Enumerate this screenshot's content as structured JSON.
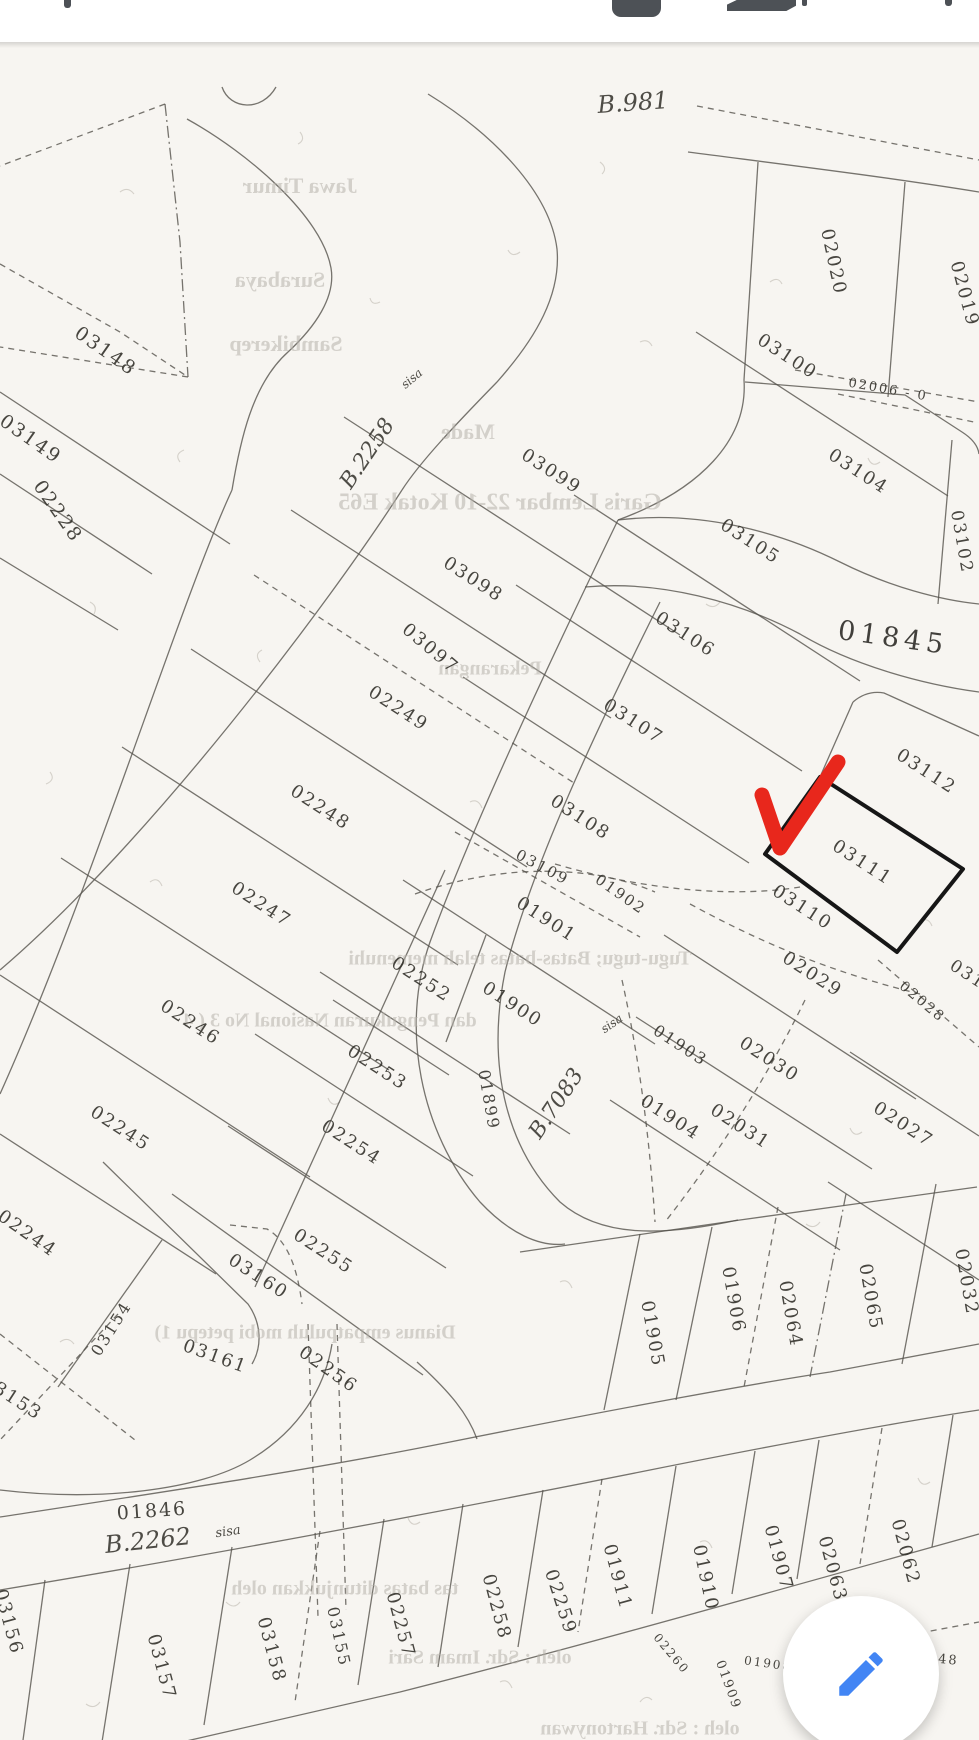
{
  "app": {
    "colors": {
      "accent_red": "#e8271c",
      "fab_blue": "#4285f4",
      "paper": "#f7f5f1",
      "icon_gray": "#4d5156"
    }
  },
  "toolbar": {
    "icons": [
      {
        "name": "share-icon"
      },
      {
        "name": "save-icon"
      },
      {
        "name": "print-icon"
      },
      {
        "name": "more-icon"
      }
    ]
  },
  "map": {
    "type": "cadastral-parcel-map",
    "selected_parcel": "03111",
    "marker": {
      "shape": "red-check-arrow",
      "color": "#e8271c",
      "points_at": "03111"
    },
    "parcel_labels": [
      {
        "t": "03148",
        "x": 105,
        "y": 310,
        "r": 35,
        "s": 19
      },
      {
        "t": "03149",
        "x": 30,
        "y": 398,
        "r": 35,
        "s": 19
      },
      {
        "t": "02228",
        "x": 57,
        "y": 470,
        "r": 55,
        "s": 19
      },
      {
        "t": "03100",
        "x": 787,
        "y": 315,
        "r": 33,
        "s": 18
      },
      {
        "t": "02020",
        "x": 833,
        "y": 220,
        "r": 78,
        "s": 18
      },
      {
        "t": "02019",
        "x": 964,
        "y": 252,
        "r": 75,
        "s": 18
      },
      {
        "t": "02006 - 0",
        "x": 888,
        "y": 348,
        "r": 10,
        "s": 13
      },
      {
        "t": "03099",
        "x": 551,
        "y": 430,
        "r": 33,
        "s": 18
      },
      {
        "t": "03104",
        "x": 858,
        "y": 430,
        "r": 33,
        "s": 18
      },
      {
        "t": "03105",
        "x": 750,
        "y": 500,
        "r": 33,
        "s": 18
      },
      {
        "t": "03098",
        "x": 473,
        "y": 538,
        "r": 33,
        "s": 18
      },
      {
        "t": "03106",
        "x": 685,
        "y": 593,
        "r": 33,
        "s": 18
      },
      {
        "t": "03097",
        "x": 430,
        "y": 607,
        "r": 40,
        "s": 18
      },
      {
        "t": "01845",
        "x": 893,
        "y": 597,
        "r": 8,
        "s": 27,
        "c": "road"
      },
      {
        "t": "03102",
        "x": 961,
        "y": 500,
        "r": 80,
        "s": 17
      },
      {
        "t": "02249",
        "x": 398,
        "y": 667,
        "r": 33,
        "s": 18
      },
      {
        "t": "03107",
        "x": 633,
        "y": 680,
        "r": 33,
        "s": 18
      },
      {
        "t": "03112",
        "x": 926,
        "y": 730,
        "r": 33,
        "s": 18
      },
      {
        "t": "02248",
        "x": 320,
        "y": 766,
        "r": 33,
        "s": 18
      },
      {
        "t": "03108",
        "x": 580,
        "y": 776,
        "r": 33,
        "s": 18
      },
      {
        "t": "03111",
        "x": 862,
        "y": 821,
        "r": 33,
        "s": 18
      },
      {
        "t": "03109",
        "x": 542,
        "y": 826,
        "r": 28,
        "s": 15
      },
      {
        "t": "01902",
        "x": 620,
        "y": 853,
        "r": 35,
        "s": 15
      },
      {
        "t": "03110",
        "x": 802,
        "y": 866,
        "r": 33,
        "s": 18
      },
      {
        "t": "02247",
        "x": 261,
        "y": 863,
        "r": 33,
        "s": 18
      },
      {
        "t": "01901",
        "x": 546,
        "y": 878,
        "r": 33,
        "s": 18
      },
      {
        "t": "02029",
        "x": 812,
        "y": 933,
        "r": 33,
        "s": 18
      },
      {
        "t": "02252",
        "x": 421,
        "y": 938,
        "r": 33,
        "s": 18
      },
      {
        "t": "01900",
        "x": 512,
        "y": 963,
        "r": 33,
        "s": 18
      },
      {
        "t": "02028",
        "x": 922,
        "y": 960,
        "r": 40,
        "s": 14
      },
      {
        "t": "02246",
        "x": 190,
        "y": 981,
        "r": 33,
        "s": 18
      },
      {
        "t": "01903",
        "x": 680,
        "y": 1004,
        "r": 33,
        "s": 16
      },
      {
        "t": "02030",
        "x": 769,
        "y": 1018,
        "r": 33,
        "s": 18
      },
      {
        "t": "02253",
        "x": 377,
        "y": 1026,
        "r": 33,
        "s": 18
      },
      {
        "t": "01899",
        "x": 488,
        "y": 1058,
        "r": 80,
        "s": 16
      },
      {
        "t": "01904",
        "x": 670,
        "y": 1076,
        "r": 33,
        "s": 18
      },
      {
        "t": "02031",
        "x": 740,
        "y": 1085,
        "r": 33,
        "s": 18
      },
      {
        "t": "02027",
        "x": 903,
        "y": 1083,
        "r": 33,
        "s": 18
      },
      {
        "t": "02245",
        "x": 120,
        "y": 1087,
        "r": 33,
        "s": 18
      },
      {
        "t": "02254",
        "x": 351,
        "y": 1101,
        "r": 33,
        "s": 18
      },
      {
        "t": "02244",
        "x": 27,
        "y": 1192,
        "r": 35,
        "s": 18
      },
      {
        "t": "02255",
        "x": 323,
        "y": 1210,
        "r": 33,
        "s": 18
      },
      {
        "t": "03160",
        "x": 258,
        "y": 1235,
        "r": 33,
        "s": 18
      },
      {
        "t": "02032",
        "x": 966,
        "y": 1240,
        "r": 80,
        "s": 18
      },
      {
        "t": "02065",
        "x": 870,
        "y": 1255,
        "r": 80,
        "s": 18
      },
      {
        "t": "01906",
        "x": 733,
        "y": 1258,
        "r": 80,
        "s": 18
      },
      {
        "t": "02064",
        "x": 790,
        "y": 1272,
        "r": 80,
        "s": 18
      },
      {
        "t": "03154",
        "x": 112,
        "y": 1287,
        "r": -58,
        "s": 16
      },
      {
        "t": "01905",
        "x": 652,
        "y": 1292,
        "r": 80,
        "s": 18
      },
      {
        "t": "03161",
        "x": 215,
        "y": 1315,
        "r": 20,
        "s": 18
      },
      {
        "t": "02256",
        "x": 328,
        "y": 1328,
        "r": 35,
        "s": 18
      },
      {
        "t": "03153",
        "x": 12,
        "y": 1356,
        "r": 33,
        "s": 18
      },
      {
        "t": "01846",
        "x": 152,
        "y": 1470,
        "r": -4,
        "s": 19
      },
      {
        "t": "02062",
        "x": 905,
        "y": 1510,
        "r": 75,
        "s": 18
      },
      {
        "t": "01907",
        "x": 778,
        "y": 1516,
        "r": 75,
        "s": 18
      },
      {
        "t": "02063",
        "x": 832,
        "y": 1527,
        "r": 75,
        "s": 18
      },
      {
        "t": "01911",
        "x": 617,
        "y": 1535,
        "r": 75,
        "s": 18
      },
      {
        "t": "01910",
        "x": 705,
        "y": 1536,
        "r": 78,
        "s": 18
      },
      {
        "t": "02259",
        "x": 560,
        "y": 1560,
        "r": 72,
        "s": 18
      },
      {
        "t": "02258",
        "x": 496,
        "y": 1565,
        "r": 75,
        "s": 18
      },
      {
        "t": "03156",
        "x": 8,
        "y": 1580,
        "r": 75,
        "s": 18
      },
      {
        "t": "02257",
        "x": 400,
        "y": 1583,
        "r": 75,
        "s": 18
      },
      {
        "t": "03155",
        "x": 338,
        "y": 1595,
        "r": 78,
        "s": 16
      },
      {
        "t": "03158",
        "x": 271,
        "y": 1608,
        "r": 75,
        "s": 18
      },
      {
        "t": "02260",
        "x": 671,
        "y": 1612,
        "r": 50,
        "s": 12
      },
      {
        "t": "02048",
        "x": 933,
        "y": 1617,
        "r": 5,
        "s": 13
      },
      {
        "t": "01908",
        "x": 768,
        "y": 1622,
        "r": 8,
        "s": 12
      },
      {
        "t": "03157",
        "x": 161,
        "y": 1625,
        "r": 75,
        "s": 18
      },
      {
        "t": "01909",
        "x": 728,
        "y": 1643,
        "r": 70,
        "s": 13
      },
      {
        "t": "03113",
        "x": 978,
        "y": 940,
        "r": 33,
        "s": 17
      }
    ],
    "script_labels": [
      {
        "t": "B.981",
        "x": 633,
        "y": 62,
        "r": -4,
        "s": 24
      },
      {
        "t": "B.2258",
        "x": 368,
        "y": 412,
        "r": -56,
        "s": 22
      },
      {
        "t": "sisa",
        "x": 412,
        "y": 337,
        "r": -40,
        "s": 12
      },
      {
        "t": "B.7083",
        "x": 557,
        "y": 1062,
        "r": -56,
        "s": 22
      },
      {
        "t": "sisa",
        "x": 612,
        "y": 982,
        "r": -35,
        "s": 12
      },
      {
        "t": "B.2262",
        "x": 148,
        "y": 1500,
        "r": -6,
        "s": 24
      },
      {
        "t": "sisa",
        "x": 228,
        "y": 1490,
        "r": -8,
        "s": 13
      }
    ],
    "bleed_through_text": [
      {
        "t": "Jawa Timur",
        "x": 300,
        "y": 146,
        "s": 22
      },
      {
        "t": "Surabaya",
        "x": 280,
        "y": 240,
        "s": 22
      },
      {
        "t": "Sambikerep",
        "x": 286,
        "y": 304,
        "s": 22
      },
      {
        "t": "Made",
        "x": 468,
        "y": 392,
        "s": 22
      },
      {
        "t": "Garis  Lembar 22-10  Kotak E65",
        "x": 500,
        "y": 462,
        "s": 24
      },
      {
        "t": "Pekarangan",
        "x": 490,
        "y": 628,
        "s": 20
      },
      {
        "t": "Tugu-tugu; Batas-batas telah memenuhi",
        "x": 520,
        "y": 918,
        "s": 20
      },
      {
        "t": "dan Pengukuran Nasional No 3 ( 4",
        "x": 330,
        "y": 980,
        "s": 20
      },
      {
        "t": "Dianus empatpuluh mobi petepu 1)",
        "x": 305,
        "y": 1292,
        "s": 20
      },
      {
        "t": "tas batas ditunjukkan oleh",
        "x": 345,
        "y": 1548,
        "s": 20
      },
      {
        "t": "oleh : Sdr. Imam Sari",
        "x": 480,
        "y": 1617,
        "s": 20
      },
      {
        "t": "oleh : Sdr. Hartonywan",
        "x": 640,
        "y": 1688,
        "s": 20
      }
    ]
  },
  "fab": {
    "name": "edit-fab",
    "icon": "pencil-icon",
    "color": "#4285f4"
  }
}
